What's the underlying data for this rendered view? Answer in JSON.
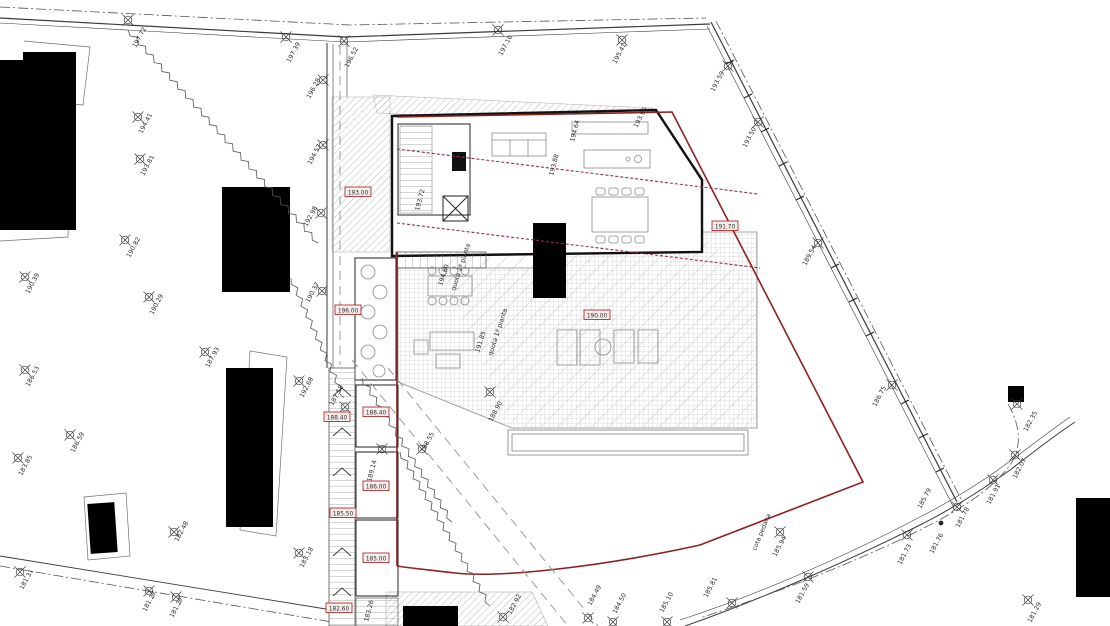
{
  "colors": {
    "ink": "#2a2a2a",
    "property_line": "#8b2020",
    "red_dashed_line": "#9c2b4a",
    "spot_box_border": "#b03030",
    "spot_box_fill": "#f6ecec",
    "spot_box_text": "#a22121",
    "building_fill": "#000000"
  },
  "survey_points": [
    {
      "x": 128,
      "y": 20,
      "label": "197.72",
      "lx": 136,
      "ly": 48,
      "rot": -62
    },
    {
      "x": 286,
      "y": 37,
      "label": "197.39",
      "lx": 290,
      "ly": 63,
      "rot": -62
    },
    {
      "x": 344,
      "y": 41,
      "label": "196.52",
      "lx": 348,
      "ly": 68,
      "rot": -62
    },
    {
      "x": 323,
      "y": 80,
      "label": "196.28",
      "lx": 310,
      "ly": 99,
      "rot": -62
    },
    {
      "x": 138,
      "y": 117,
      "label": "194.41",
      "lx": 142,
      "ly": 134,
      "rot": -62
    },
    {
      "x": 140,
      "y": 159,
      "label": "193.81",
      "lx": 144,
      "ly": 176,
      "rot": -62
    },
    {
      "x": 323,
      "y": 145,
      "label": "194.57",
      "lx": 311,
      "ly": 165,
      "rot": -62
    },
    {
      "x": 498,
      "y": 30,
      "label": "197.16",
      "lx": 502,
      "ly": 56,
      "rot": -62
    },
    {
      "x": 622,
      "y": 40,
      "label": "195.41",
      "lx": 616,
      "ly": 64,
      "rot": -62
    },
    {
      "x": 728,
      "y": 66,
      "label": "193.59",
      "lx": 714,
      "ly": 92,
      "rot": -62
    },
    {
      "x": 758,
      "y": 122,
      "label": "193.50",
      "lx": 746,
      "ly": 148,
      "rot": -62
    },
    {
      "x": 818,
      "y": 243,
      "label": "189.54",
      "lx": 806,
      "ly": 266,
      "rot": -62
    },
    {
      "x": 892,
      "y": 385,
      "label": "186.75",
      "lx": 876,
      "ly": 407,
      "rot": -62
    },
    {
      "x": 125,
      "y": 240,
      "label": "190.82",
      "lx": 130,
      "ly": 258,
      "rot": -62
    },
    {
      "x": 25,
      "y": 277,
      "label": "190.39",
      "lx": 29,
      "ly": 294,
      "rot": -62
    },
    {
      "x": 149,
      "y": 297,
      "label": "190.29",
      "lx": 153,
      "ly": 315,
      "rot": -62
    },
    {
      "x": 205,
      "y": 352,
      "label": "187.93",
      "lx": 209,
      "ly": 368,
      "rot": -62
    },
    {
      "x": 25,
      "y": 370,
      "label": "186.53",
      "lx": 29,
      "ly": 387,
      "rot": -62
    },
    {
      "x": 70,
      "y": 435,
      "label": "186.59",
      "lx": 74,
      "ly": 453,
      "rot": -62
    },
    {
      "x": 18,
      "y": 458,
      "label": "183.85",
      "lx": 22,
      "ly": 476,
      "rot": -62
    },
    {
      "x": 321,
      "y": 213,
      "label": "192.98",
      "lx": 307,
      "ly": 227,
      "rot": -62
    },
    {
      "x": 322,
      "y": 291,
      "label": "190.37",
      "lx": 309,
      "ly": 303,
      "rot": -62
    },
    {
      "x": 299,
      "y": 381,
      "label": "192.68",
      "lx": 303,
      "ly": 398,
      "rot": -62
    },
    {
      "x": 345,
      "y": 407,
      "label": "187.58",
      "lx": 333,
      "ly": 406,
      "rot": -62
    },
    {
      "x": 382,
      "y": 449,
      "label": "189.14",
      "lx": 371,
      "ly": 482,
      "rot": -75
    },
    {
      "x": 422,
      "y": 449,
      "label": "188.55",
      "lx": 424,
      "ly": 453,
      "rot": -62
    },
    {
      "x": 490,
      "y": 392,
      "label": "188.90",
      "lx": 492,
      "ly": 422,
      "rot": -62
    },
    {
      "x": 20,
      "y": 572,
      "label": "181.31",
      "lx": 23,
      "ly": 590,
      "rot": -62
    },
    {
      "x": 149,
      "y": 591,
      "label": "181.27",
      "lx": 146,
      "ly": 612,
      "rot": -62
    },
    {
      "x": 176,
      "y": 597,
      "label": "181.27",
      "lx": 173,
      "ly": 618,
      "rot": -62
    },
    {
      "x": 174,
      "y": 532,
      "label": "182.48",
      "lx": 178,
      "ly": 542,
      "rot": -62
    },
    {
      "x": 299,
      "y": 553,
      "label": "183.18",
      "lx": 303,
      "ly": 568,
      "rot": -62
    },
    {
      "x": 503,
      "y": 617,
      "label": "182.92",
      "lx": 511,
      "ly": 615,
      "rot": -62
    },
    {
      "x": 588,
      "y": 618,
      "label": "184.49",
      "lx": 591,
      "ly": 606,
      "rot": -62
    },
    {
      "x": 613,
      "y": 622,
      "label": "184.50",
      "lx": 616,
      "ly": 614,
      "rot": -62
    },
    {
      "x": 667,
      "y": 622,
      "label": "185.10",
      "lx": 663,
      "ly": 613,
      "rot": -62
    },
    {
      "x": 732,
      "y": 603,
      "label": "185.81",
      "lx": 707,
      "ly": 598,
      "rot": -62
    },
    {
      "x": 780,
      "y": 532,
      "label": "185.94",
      "lx": 776,
      "ly": 557,
      "rot": -62
    },
    {
      "x": 808,
      "y": 577,
      "label": "181.59",
      "lx": 799,
      "ly": 604,
      "rot": -62
    },
    {
      "x": 907,
      "y": 535,
      "label": "181.73",
      "lx": 901,
      "ly": 565,
      "rot": -62
    },
    {
      "x": 941,
      "y": 523,
      "label": "181.76",
      "lx": 933,
      "ly": 554,
      "rot": -62,
      "style": "dot"
    },
    {
      "x": 957,
      "y": 507,
      "label": "181.78",
      "lx": 959,
      "ly": 528,
      "rot": -62
    },
    {
      "x": 993,
      "y": 480,
      "label": "181.91",
      "lx": 990,
      "ly": 505,
      "rot": -62
    },
    {
      "x": 1015,
      "y": 455,
      "label": "182.07",
      "lx": 1016,
      "ly": 479,
      "rot": -62
    },
    {
      "x": 1017,
      "y": 404,
      "label": "182.35",
      "lx": 1027,
      "ly": 432,
      "rot": -62
    },
    {
      "x": 1028,
      "y": 600,
      "label": "181.29",
      "lx": 1031,
      "ly": 623,
      "rot": -62
    }
  ],
  "spot_elevations": [
    {
      "x": 358,
      "y": 192,
      "label": "193.00"
    },
    {
      "x": 348,
      "y": 310,
      "label": "196.00"
    },
    {
      "x": 597,
      "y": 315,
      "label": "190.00"
    },
    {
      "x": 725,
      "y": 226,
      "label": "191.70"
    },
    {
      "x": 337,
      "y": 417,
      "label": "188.40"
    },
    {
      "x": 376,
      "y": 412,
      "label": "186.40"
    },
    {
      "x": 376,
      "y": 486,
      "label": "186.00"
    },
    {
      "x": 343,
      "y": 513,
      "label": "185.50"
    },
    {
      "x": 376,
      "y": 558,
      "label": "185.00"
    },
    {
      "x": 339,
      "y": 608,
      "label": "182.60"
    }
  ],
  "annotations": [
    {
      "x": 637,
      "y": 128,
      "label": "193.96",
      "rot": -62
    },
    {
      "x": 574,
      "y": 142,
      "label": "194.64",
      "rot": -75
    },
    {
      "x": 553,
      "y": 176,
      "label": "193.88",
      "rot": -75
    },
    {
      "x": 419,
      "y": 211,
      "label": "193.72",
      "rot": -75
    },
    {
      "x": 442,
      "y": 286,
      "label": "194.60",
      "rot": -72
    },
    {
      "x": 455,
      "y": 291,
      "label": "quota 2ª pianta",
      "rot": -72
    },
    {
      "x": 479,
      "y": 353,
      "label": "191.85",
      "rot": -72
    },
    {
      "x": 492,
      "y": 356,
      "label": "quota 1ª pianta",
      "rot": -72
    },
    {
      "x": 368,
      "y": 622,
      "label": "183.26",
      "rot": -75
    },
    {
      "x": 756,
      "y": 551,
      "label": "cota pedana",
      "rot": -68
    },
    {
      "x": 921,
      "y": 509,
      "label": "185.79",
      "rot": -62
    }
  ]
}
